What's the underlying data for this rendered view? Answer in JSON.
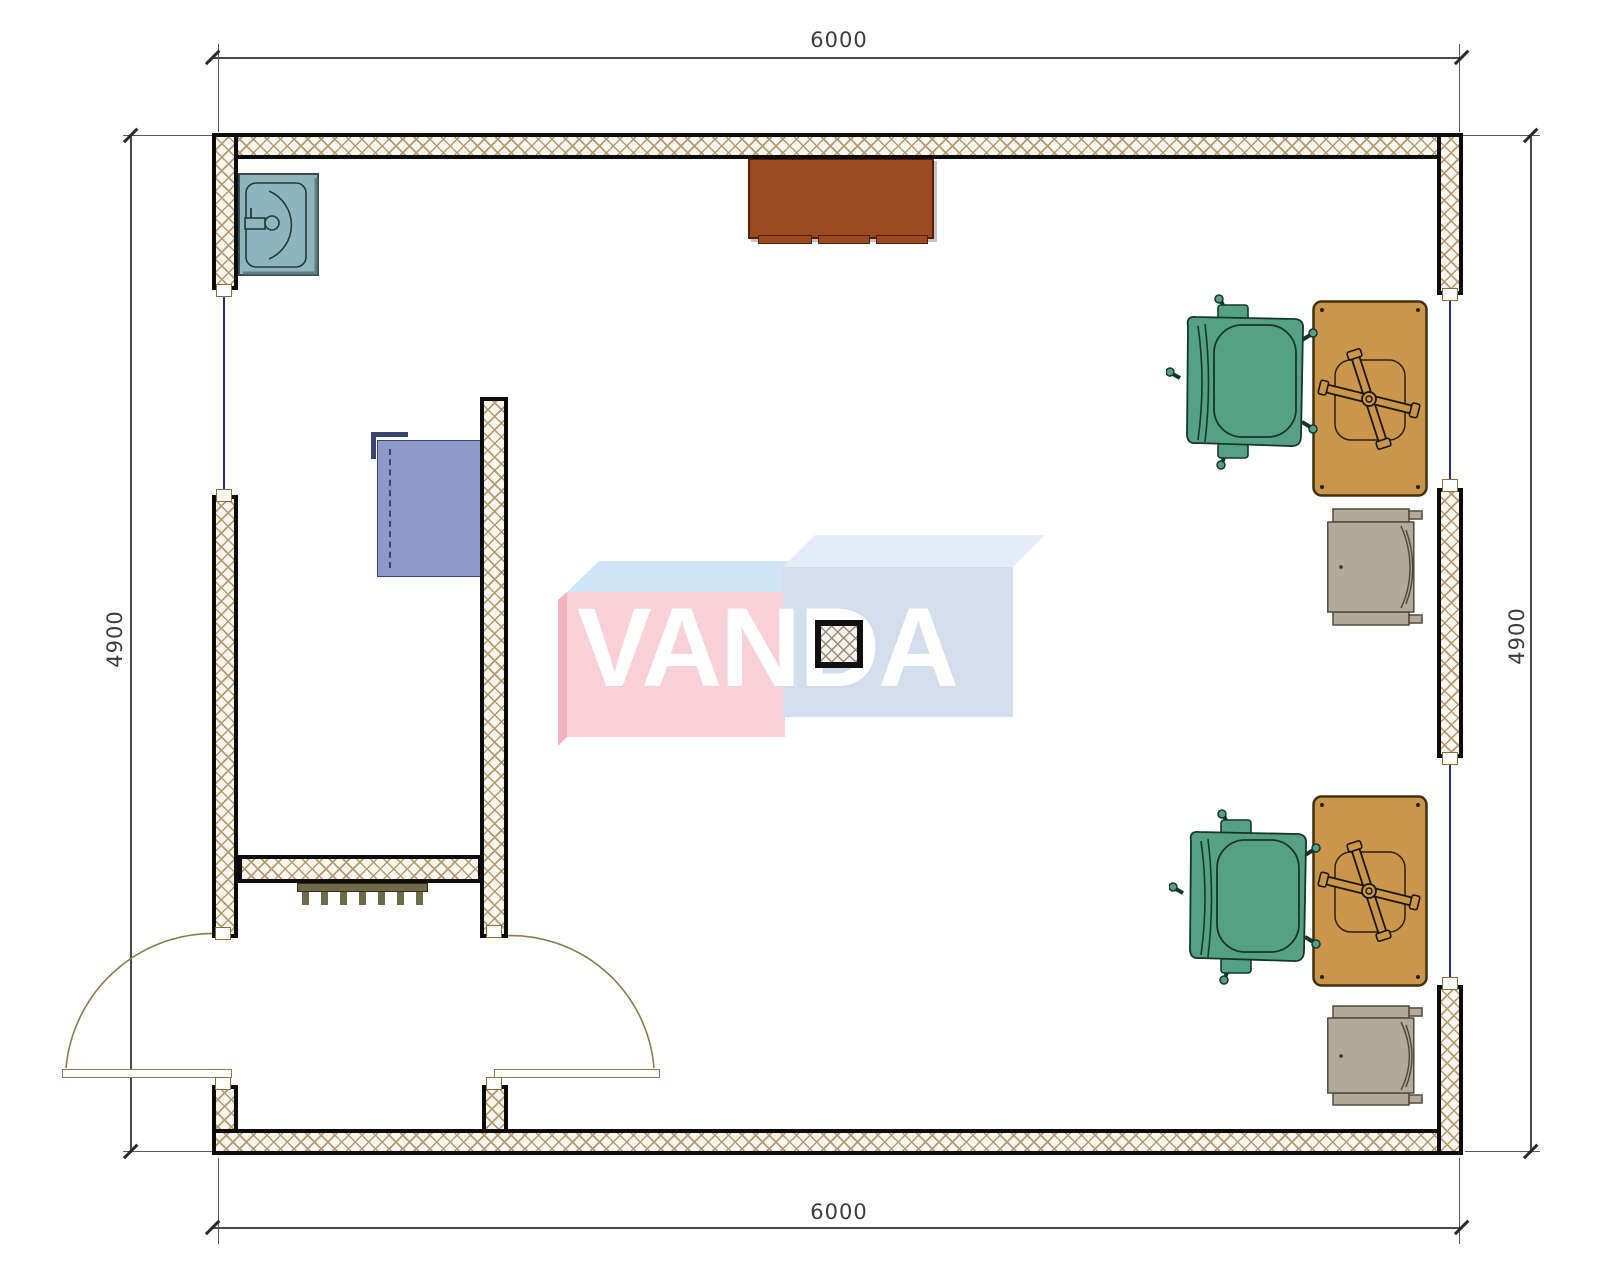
{
  "dimensions": {
    "top": "6000",
    "bottom": "6000",
    "left": "4900",
    "right": "4900"
  },
  "watermark": {
    "text": "VANDA",
    "left_box_front_color": "#f8d0d8",
    "left_box_top_color": "#cfe4f6",
    "left_box_side_color": "#f2b3c0",
    "right_box_front_color": "#d3ddec",
    "right_box_top_color": "#e4edf8",
    "text_color": "#ffffff"
  },
  "colors": {
    "wall_hatch": "#b59a71",
    "wall_line": "#0c0c0c",
    "window_line": "#27357a",
    "door_swing": "#8a7a50",
    "sink": "#8fb5bc",
    "sideboard": "#9c4a21",
    "wardrobe": "#8d99c9",
    "radiator": "#6f6a4a",
    "desk": "#c9964b",
    "office_chair": "#56a185",
    "printer": "#b3a99c"
  },
  "furniture": [
    {
      "name": "sink",
      "color": "#8fb5bc"
    },
    {
      "name": "sideboard",
      "color": "#9c4a21"
    },
    {
      "name": "wardrobe",
      "color": "#8d99c9"
    },
    {
      "name": "radiator",
      "color": "#6f6a4a"
    },
    {
      "name": "desk-top",
      "color": "#c9964b"
    },
    {
      "name": "desk-bottom",
      "color": "#c9964b"
    },
    {
      "name": "office-chair-top",
      "color": "#56a185"
    },
    {
      "name": "office-chair-bottom",
      "color": "#56a185"
    },
    {
      "name": "printer-top",
      "color": "#b3a99c"
    },
    {
      "name": "printer-bottom",
      "color": "#b3a99c"
    },
    {
      "name": "structural-column",
      "color": "#0c0c0c"
    }
  ]
}
